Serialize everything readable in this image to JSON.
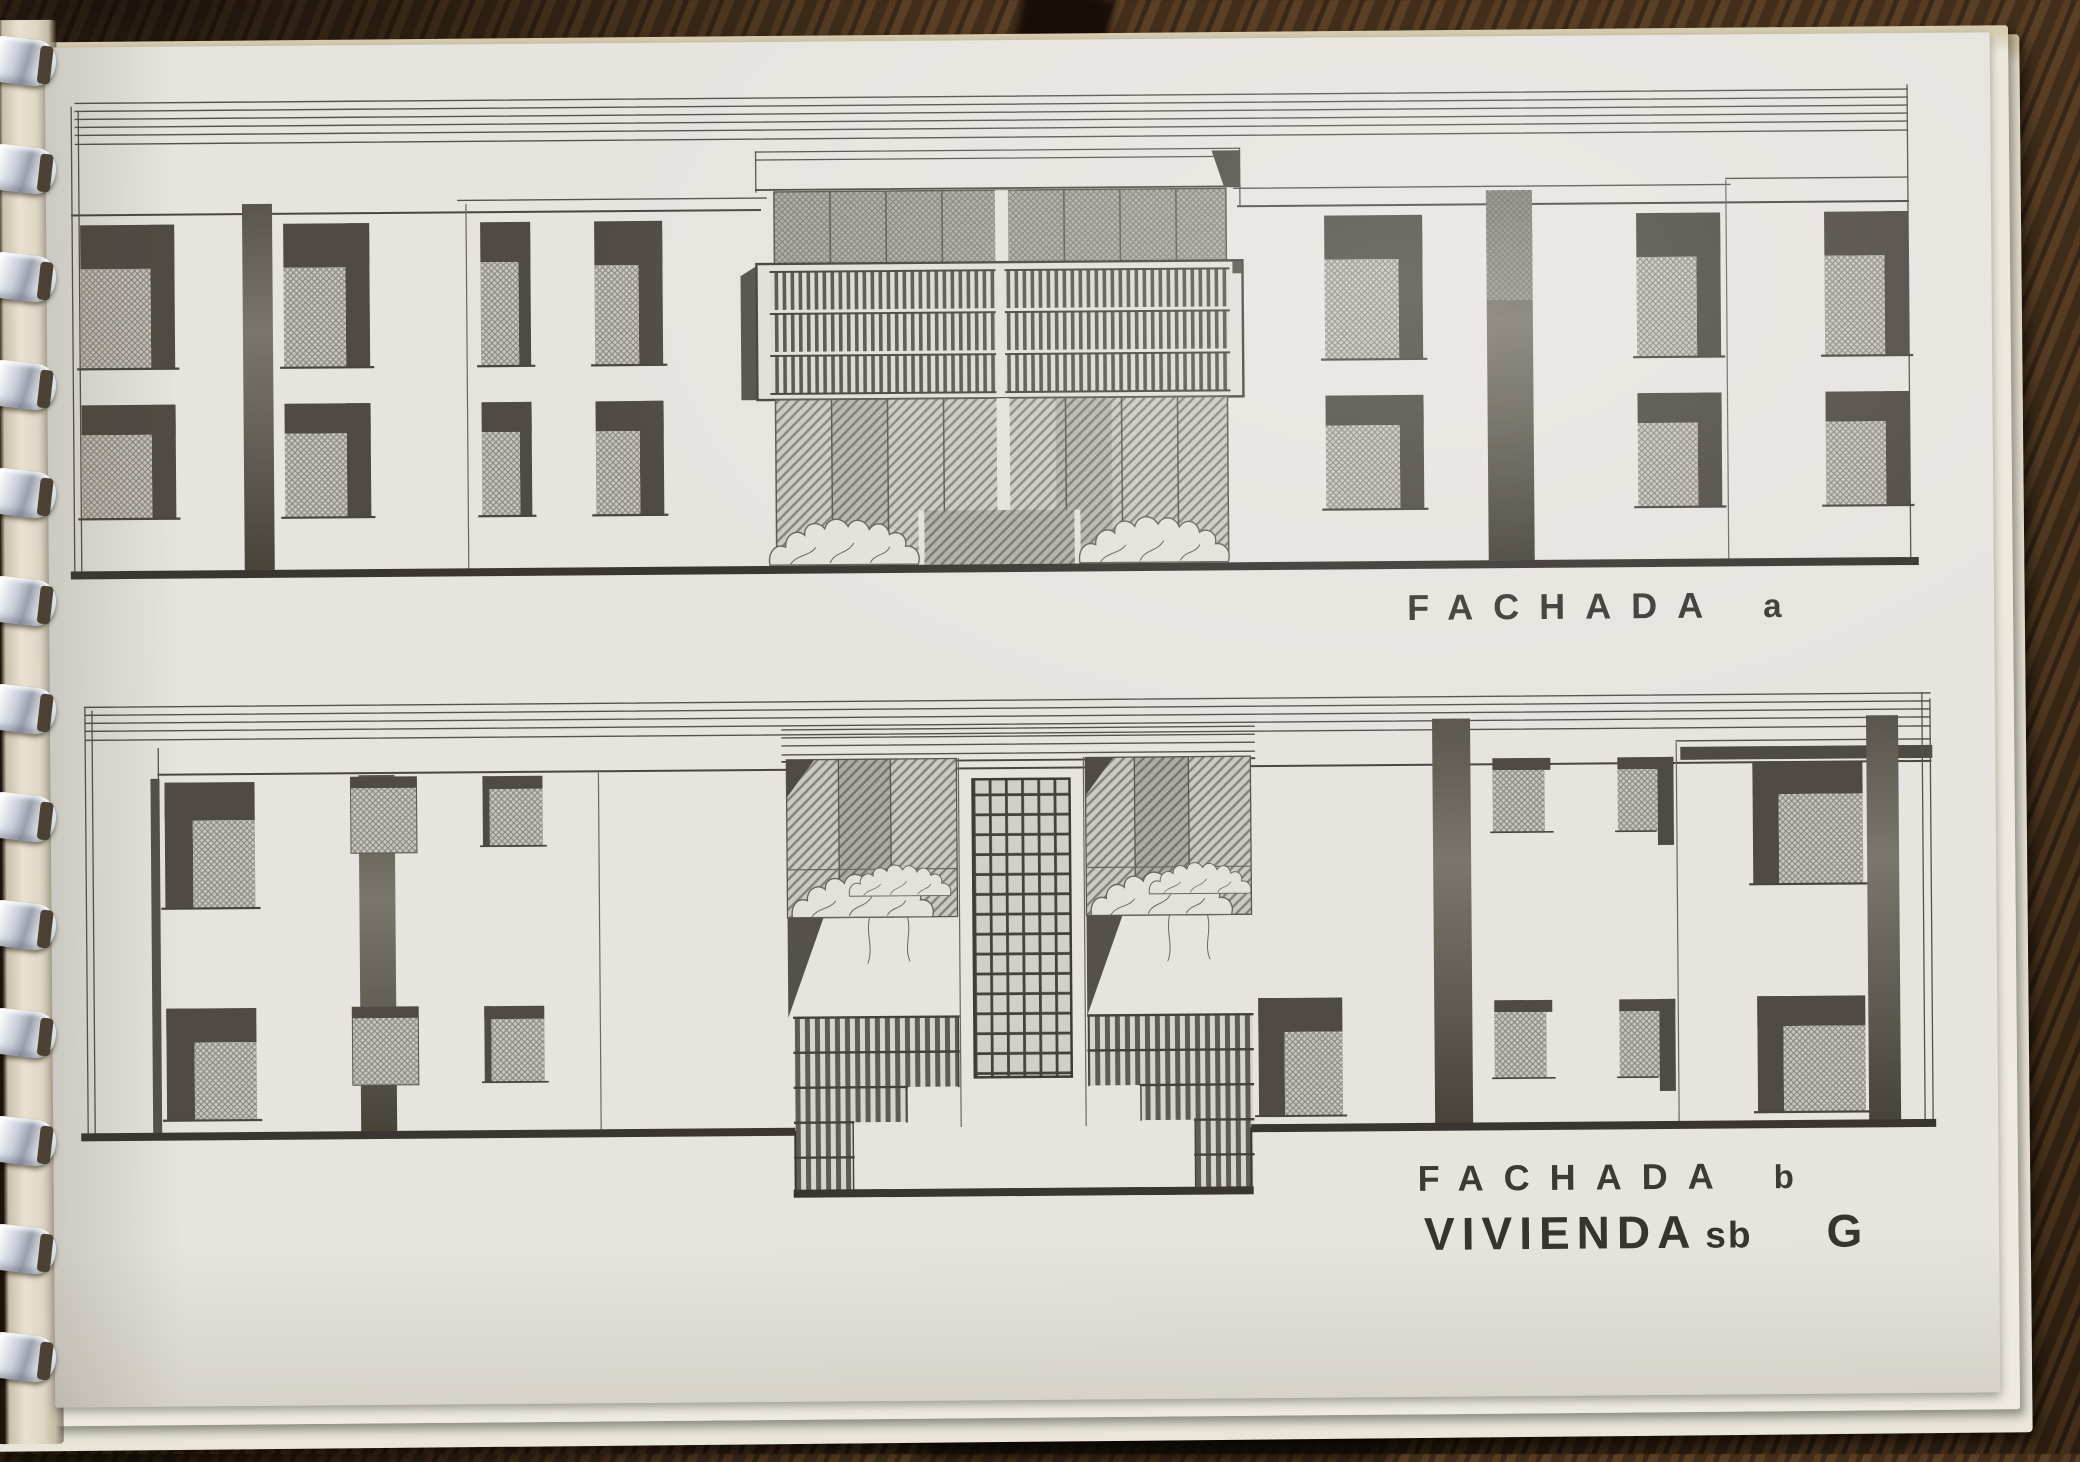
{
  "scene": {
    "subject": "Spiral-bound booklet page with two architectural facade elevation drawings, photographed on a dark wood table"
  },
  "labels": {
    "facade_a": {
      "word": "FACHADA",
      "suffix": "a"
    },
    "facade_b": {
      "word": "FACHADA",
      "suffix": "b"
    },
    "dwelling": {
      "word": "VIVIENDA",
      "subtype": "sb",
      "unit": "G"
    }
  },
  "drawing": {
    "facade_a": {
      "caption": "FACHADA a",
      "stories": 2,
      "window_bays_upper": 7,
      "window_bays_lower": 7,
      "center_feature": "recessed balcony with slatted railing over glazed ground floor with shrubs"
    },
    "facade_b": {
      "caption": "FACHADA b",
      "stories": 2,
      "center_feature": "perforated concrete screen flanked by glazed patios with trees and stepped slatted walls"
    }
  },
  "colors": {
    "paper": "#e6e4df",
    "ink": "#48433d",
    "shadow": "#4f4a43",
    "glass": "#b7b4ad",
    "wood": "#3a2817",
    "binding_comb": "#dfe3ea"
  }
}
